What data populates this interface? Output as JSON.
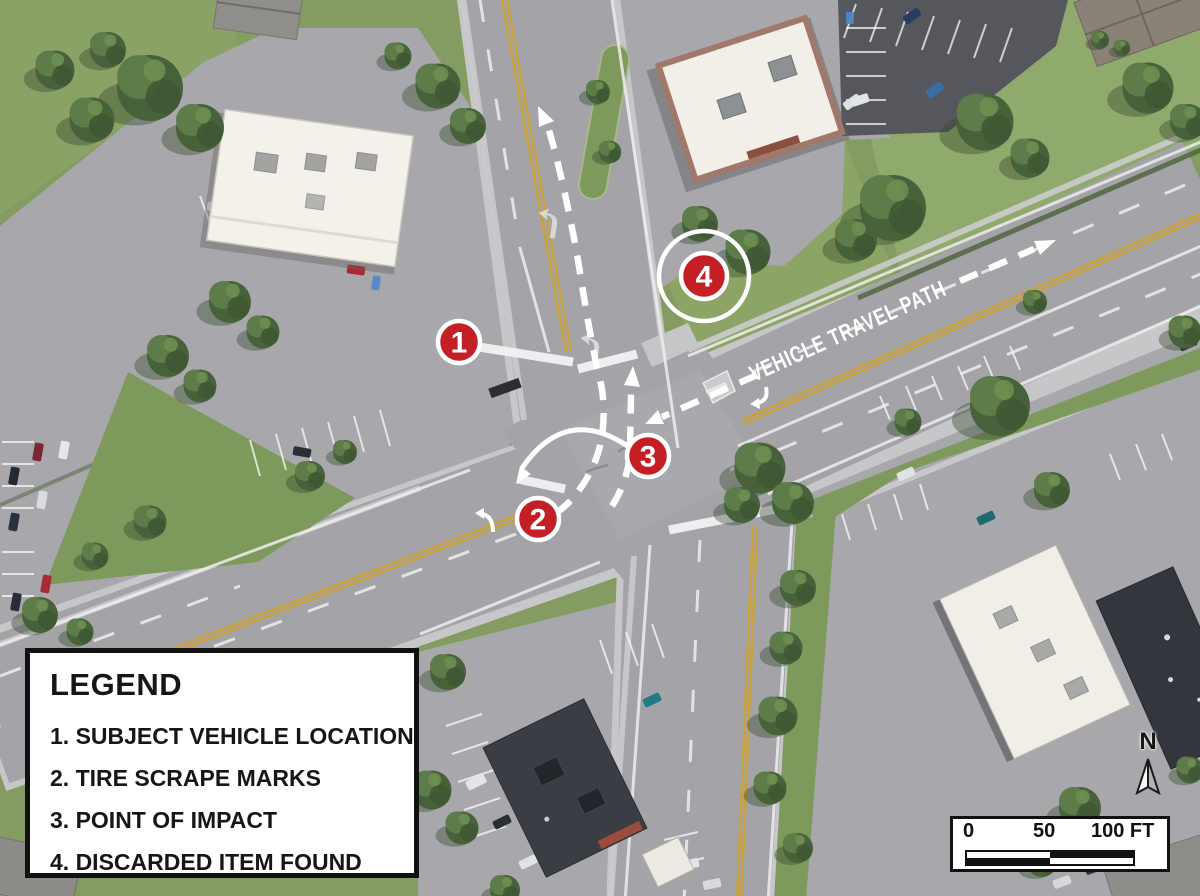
{
  "legend": {
    "title": "LEGEND",
    "items": [
      "1. SUBJECT VEHICLE LOCATION",
      "2. TIRE SCRAPE MARKS",
      "3. POINT OF IMPACT",
      "4. DISCARDED ITEM FOUND"
    ]
  },
  "markers": [
    {
      "label": "1"
    },
    {
      "label": "2"
    },
    {
      "label": "3"
    },
    {
      "label": "4"
    }
  ],
  "travel_path": {
    "label": "VEHICLE TRAVEL PATH"
  },
  "compass": {
    "label": "N"
  },
  "scale_bar": {
    "ticks": [
      "0",
      "50",
      "100 FT"
    ]
  },
  "colors": {
    "marker_red": "#c51f26",
    "road_gray": "#a4a4a8",
    "grass_green": "#849c62",
    "legend_border": "#111111"
  }
}
